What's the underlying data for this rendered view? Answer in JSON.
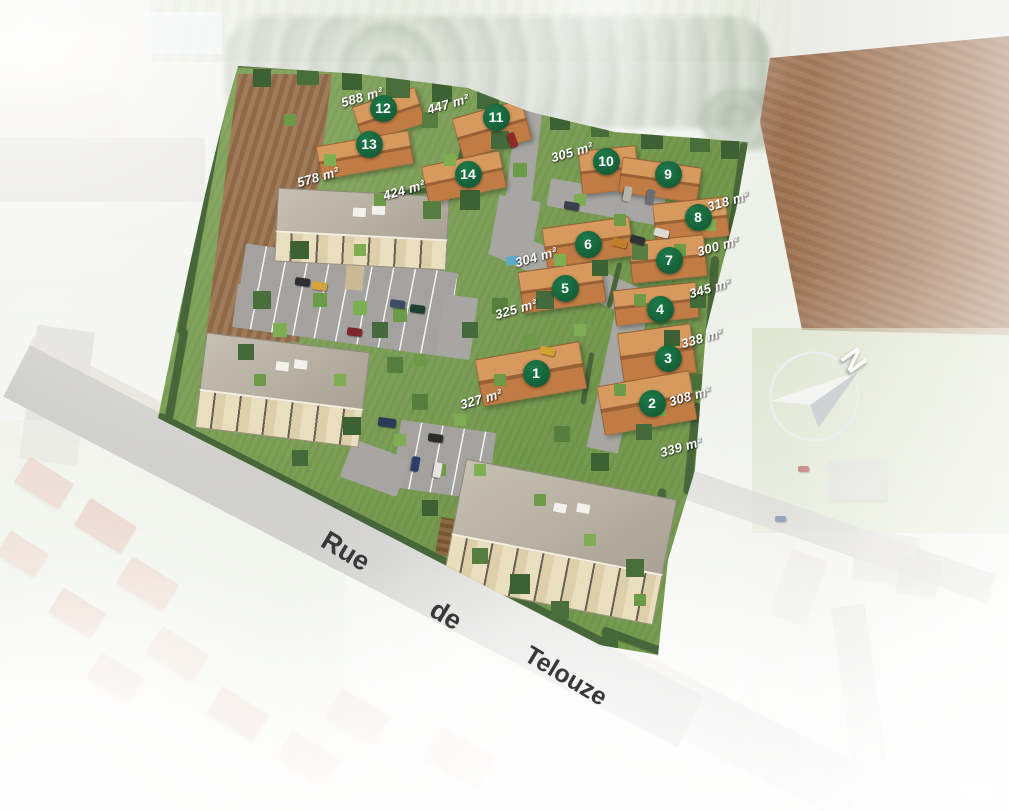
{
  "meta": {
    "title": "Plan de masse aérien — lotissement Rue de Telouze"
  },
  "colors": {
    "lot_marker_green": "#17663c",
    "area_label_text": "#ffffff",
    "street_text": "#38383a",
    "site_grass": "#7ea256",
    "field_brown": "#96684a",
    "roof_terracotta": "#c98a52"
  },
  "compass": {
    "label": "N"
  },
  "street": {
    "words": [
      "Rue",
      "de",
      "Telouze"
    ]
  },
  "lot_markers": [
    {
      "number": "1"
    },
    {
      "number": "2"
    },
    {
      "number": "3"
    },
    {
      "number": "4"
    },
    {
      "number": "5"
    },
    {
      "number": "6"
    },
    {
      "number": "7"
    },
    {
      "number": "8"
    },
    {
      "number": "9"
    },
    {
      "number": "10"
    },
    {
      "number": "11"
    },
    {
      "number": "12"
    },
    {
      "number": "13"
    },
    {
      "number": "14"
    }
  ],
  "area_labels": [
    {
      "text": "588 m²"
    },
    {
      "text": "447 m²"
    },
    {
      "text": "578 m²"
    },
    {
      "text": "424 m²"
    },
    {
      "text": "305 m²"
    },
    {
      "text": "318 m²"
    },
    {
      "text": "300 m²"
    },
    {
      "text": "304 m²"
    },
    {
      "text": "345 m²"
    },
    {
      "text": "325 m²"
    },
    {
      "text": "338 m²"
    },
    {
      "text": "308 m²"
    },
    {
      "text": "327 m²"
    },
    {
      "text": "339 m²"
    }
  ]
}
